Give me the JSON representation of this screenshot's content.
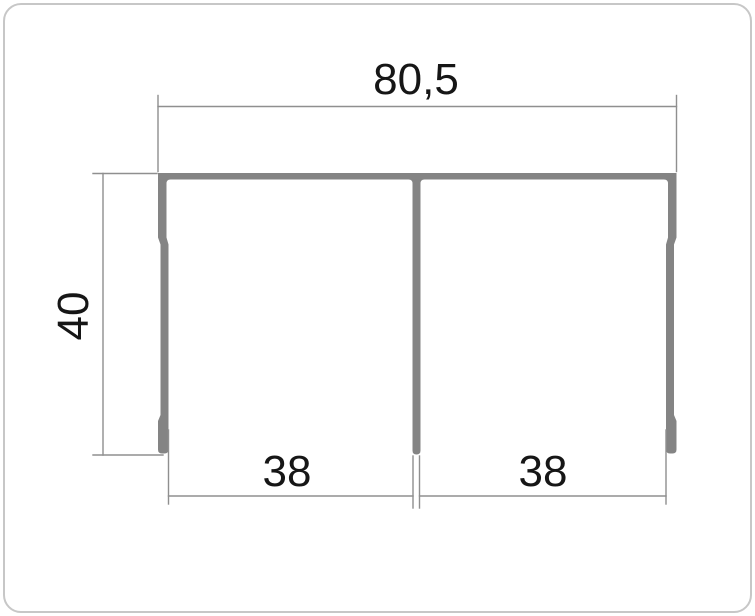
{
  "drawing": {
    "type": "profile-cross-section-dimension-drawing",
    "labels": {
      "overall_width": "80,5",
      "height": "40",
      "bay_left": "38",
      "bay_right": "38"
    },
    "colors": {
      "profile": "#848484",
      "dimension": "#8f8f8f",
      "text": "#161616",
      "card_border": "#c7c7c7",
      "background": "#ffffff"
    }
  }
}
